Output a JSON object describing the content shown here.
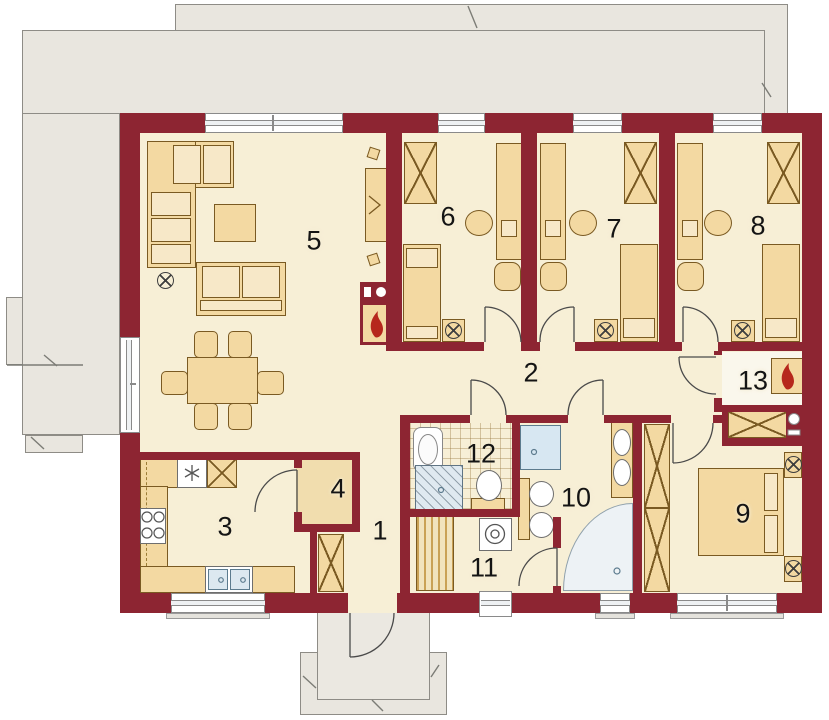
{
  "plan": {
    "type": "house-floor-plan",
    "room_labels": [
      "1",
      "2",
      "3",
      "4",
      "5",
      "6",
      "7",
      "8",
      "9",
      "10",
      "11",
      "12",
      "13"
    ]
  },
  "colors": {
    "wall": "#8d2532",
    "floor": "#f7efd6",
    "furniture": "#f3d9a2",
    "furniture_outline": "#7a5a22",
    "terrace": "#e9e6df",
    "glass": "#eef1f3",
    "fixture_blue": "#dfe9f0",
    "flame": "#b6271c"
  }
}
